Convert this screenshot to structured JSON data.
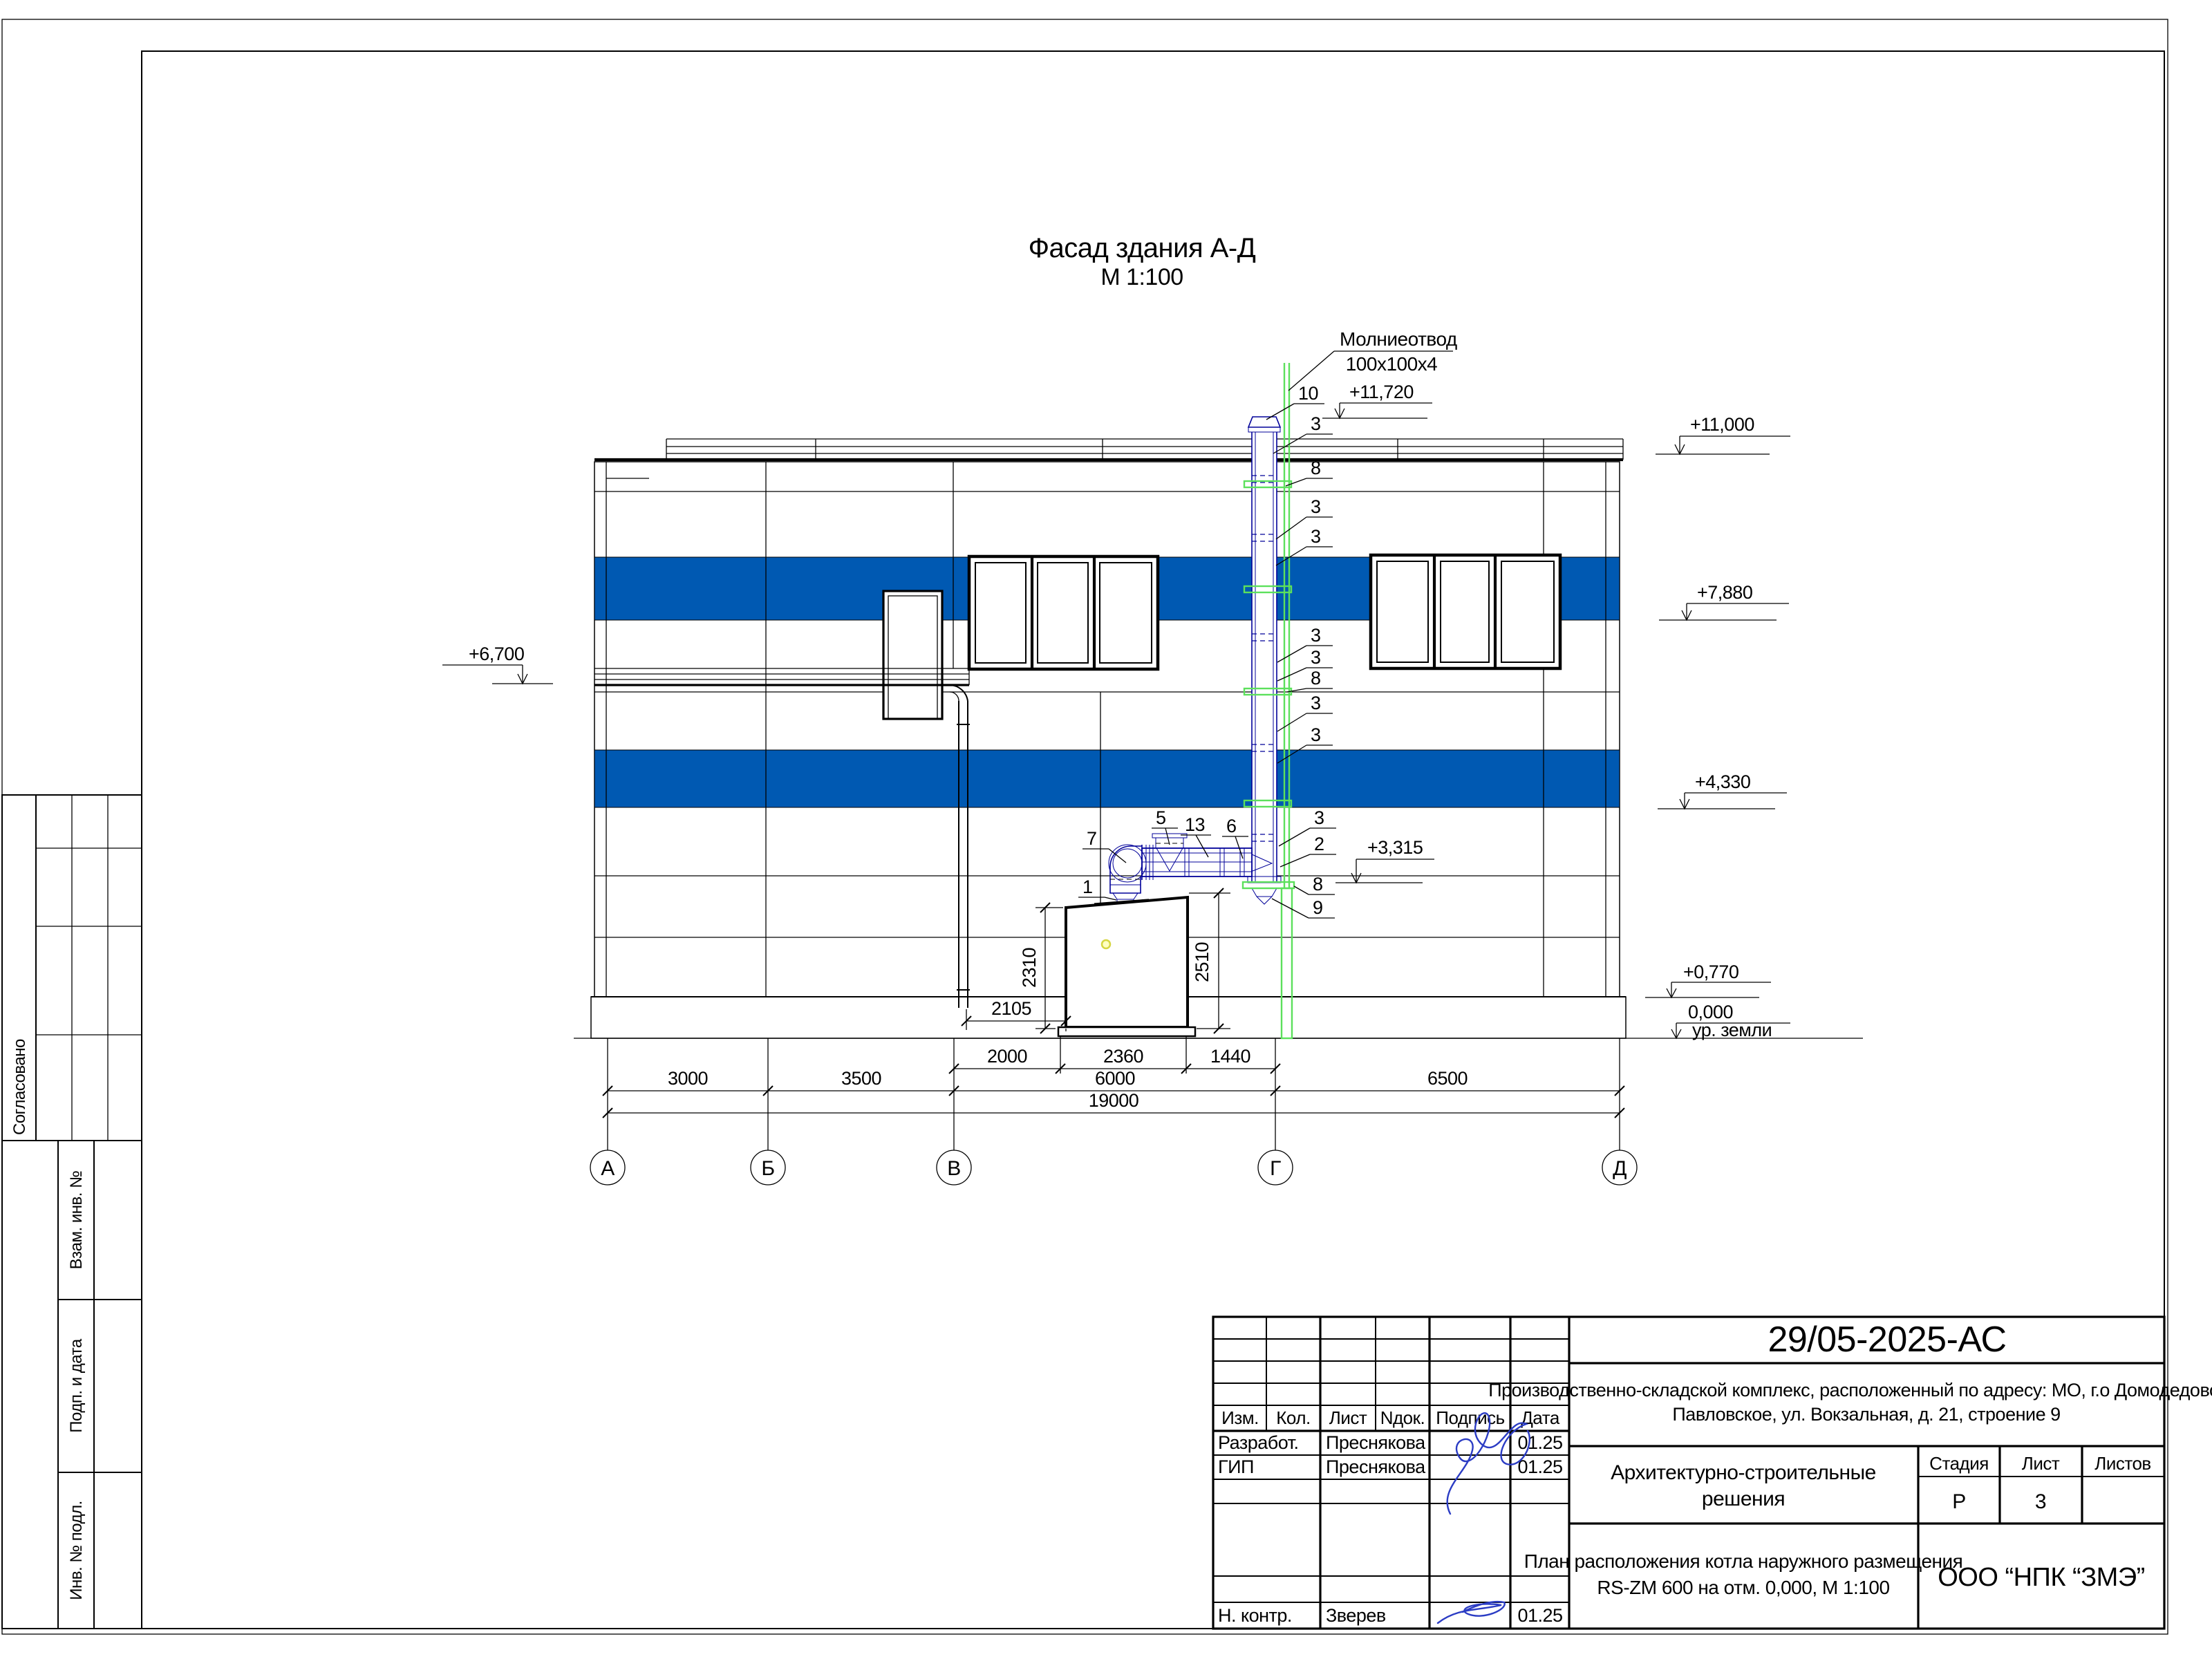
{
  "drawing": {
    "title": "Фасад здания А-Д",
    "scale": "М 1:100"
  },
  "facade": {
    "lightning_rod": {
      "label": "Молниеотвод",
      "size": "100х100х4"
    },
    "elevations": {
      "chimney_top": "+11,720",
      "roof": "+11,000",
      "band1": "+7,880",
      "band2": "+4,330",
      "duct": "+3,315",
      "canopy": "+6,700",
      "plinth": "+0,770",
      "zero": "0,000",
      "ground": "ур. земли"
    },
    "callouts": [
      "10",
      "3",
      "8",
      "3",
      "3",
      "3",
      "3",
      "8",
      "3",
      "3",
      "3",
      "2",
      "8",
      "9",
      "7",
      "5",
      "13",
      "6",
      "1"
    ],
    "dims": {
      "h_left": "2310",
      "h_right": "2510",
      "offset": "2105",
      "seg1": "2000",
      "seg2": "2360",
      "seg3": "1440",
      "ab": "3000",
      "bv": "3500",
      "vg": "6000",
      "gd": "6500",
      "total": "19000"
    },
    "axes": [
      "А",
      "Б",
      "В",
      "Г",
      "Д"
    ]
  },
  "side_stamp": {
    "approved": "Согласовано",
    "vzam": "Взам. инв. №",
    "podp": "Подп. и дата",
    "inv": "Инв. № подл."
  },
  "title_block": {
    "doc_number": "29/05-2025-АС",
    "project_line1": "Производственно-складской комплекс, расположенный по адресу: МО, г.о Домодедово, д.",
    "project_line2": "Павловское, ул. Вокзальная, д. 21, строение 9",
    "section_line1": "Архитектурно-строительные",
    "section_line2": "решения",
    "sheet_title_line1": "План расположения котла наружного размещения",
    "sheet_title_line2": "RS-ZM 600 на отм. 0,000,  М 1:100",
    "company": "ООО “НПК “ЗМЭ”",
    "headers": {
      "izm": "Изм.",
      "kol": "Кол.",
      "list": "Лист",
      "ndok": "Nдок.",
      "podpis": "Подпись",
      "data": "Дата",
      "stage": "Стадия",
      "sheet": "Лист",
      "sheets": "Листов"
    },
    "values": {
      "stage": "Р",
      "sheet": "3",
      "sheets": ""
    },
    "signers": [
      {
        "role": "Разработ.",
        "name": "Преснякова",
        "date": "01.25"
      },
      {
        "role": "ГИП",
        "name": "Преснякова",
        "date": "01.25"
      },
      {
        "role": "Н. контр.",
        "name": "Зверев",
        "date": "01.25"
      }
    ]
  },
  "colors": {
    "band": "#0059b2",
    "pipe": "#000099",
    "rod": "#5ce05c",
    "signature": "#2b3cc4",
    "marker": "#d6d642"
  }
}
